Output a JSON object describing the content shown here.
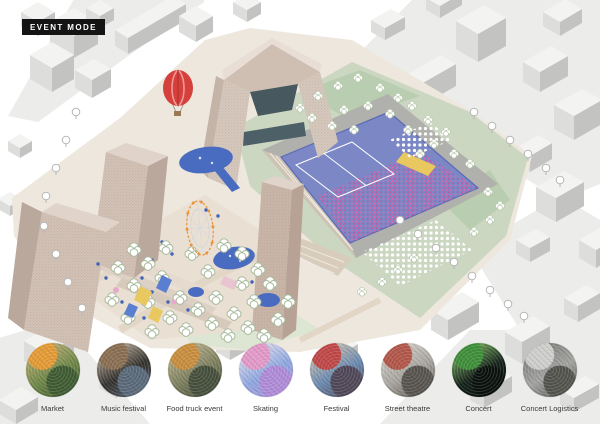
{
  "badge": {
    "label": "EVENT MODE"
  },
  "scene": {
    "elements": [
      "city-blocks",
      "hot-air-balloon-icon",
      "arch-building",
      "residential-towers",
      "observation-tower",
      "event-pool-with-crowd",
      "stage-platform",
      "ferris-wheel-icon",
      "ponds",
      "market-stalls",
      "park-trees",
      "street-trees",
      "podium-terraces"
    ],
    "palette": {
      "block_top": "#f3f3f2",
      "block_dark": "#c3c3c2",
      "block_light": "#dddddc",
      "site_ground": "#eee7de",
      "green_light": "#ccd7c2",
      "green_mid": "#b9cdb0",
      "green_pale": "#dce6d2",
      "tower_front": "#d2c1b5",
      "tower_side": "#bba89c",
      "tower_top": "#e0d3c9",
      "arch_glass": "#47585e",
      "pool_deck": "#b0b0ac",
      "pool_blue": "#7c88c6",
      "pool_edge": "#5a6ab5",
      "crowd_pink": "#e264ab",
      "stage_yellow": "#e9c95f",
      "pond_blue": "#4a6cc0",
      "balloon_red": "#d6403c",
      "ferris_orange": "#e8973f",
      "stall_blue": "#5b7fd0",
      "stall_pink": "#e5a9c9",
      "path_tan": "#e2d6c6"
    }
  },
  "events": [
    {
      "label": "Market",
      "photo_colors": [
        "#e59b35",
        "#6f8747",
        "#c9b27a",
        "#3f5c33"
      ]
    },
    {
      "label": "Music festival",
      "photo_colors": [
        "#8a6f52",
        "#33302c",
        "#cbbca9",
        "#5a6a7a"
      ]
    },
    {
      "label": "Food truck event",
      "photo_colors": [
        "#c98f3f",
        "#7d7f5e",
        "#c2b896",
        "#46503c"
      ]
    },
    {
      "label": "Skating",
      "photo_colors": [
        "#e39ac9",
        "#8fa8e0",
        "#e9e2ee",
        "#b08cd8"
      ]
    },
    {
      "label": "Festival",
      "photo_colors": [
        "#c04848",
        "#6a8ab0",
        "#d8c8ae",
        "#504858"
      ]
    },
    {
      "label": "Street theatre",
      "photo_colors": [
        "#b2574a",
        "#a8a49e",
        "#d8d4cc",
        "#58544e"
      ]
    },
    {
      "label": "Concert",
      "photo_colors": [
        "#3f8f3a",
        "#14201a",
        "#88c868",
        "#0b120d"
      ]
    },
    {
      "label": "Concert Logistics",
      "photo_colors": [
        "#cfcfcd",
        "#a3a3a1",
        "#7b7b77",
        "#54544f"
      ]
    }
  ]
}
